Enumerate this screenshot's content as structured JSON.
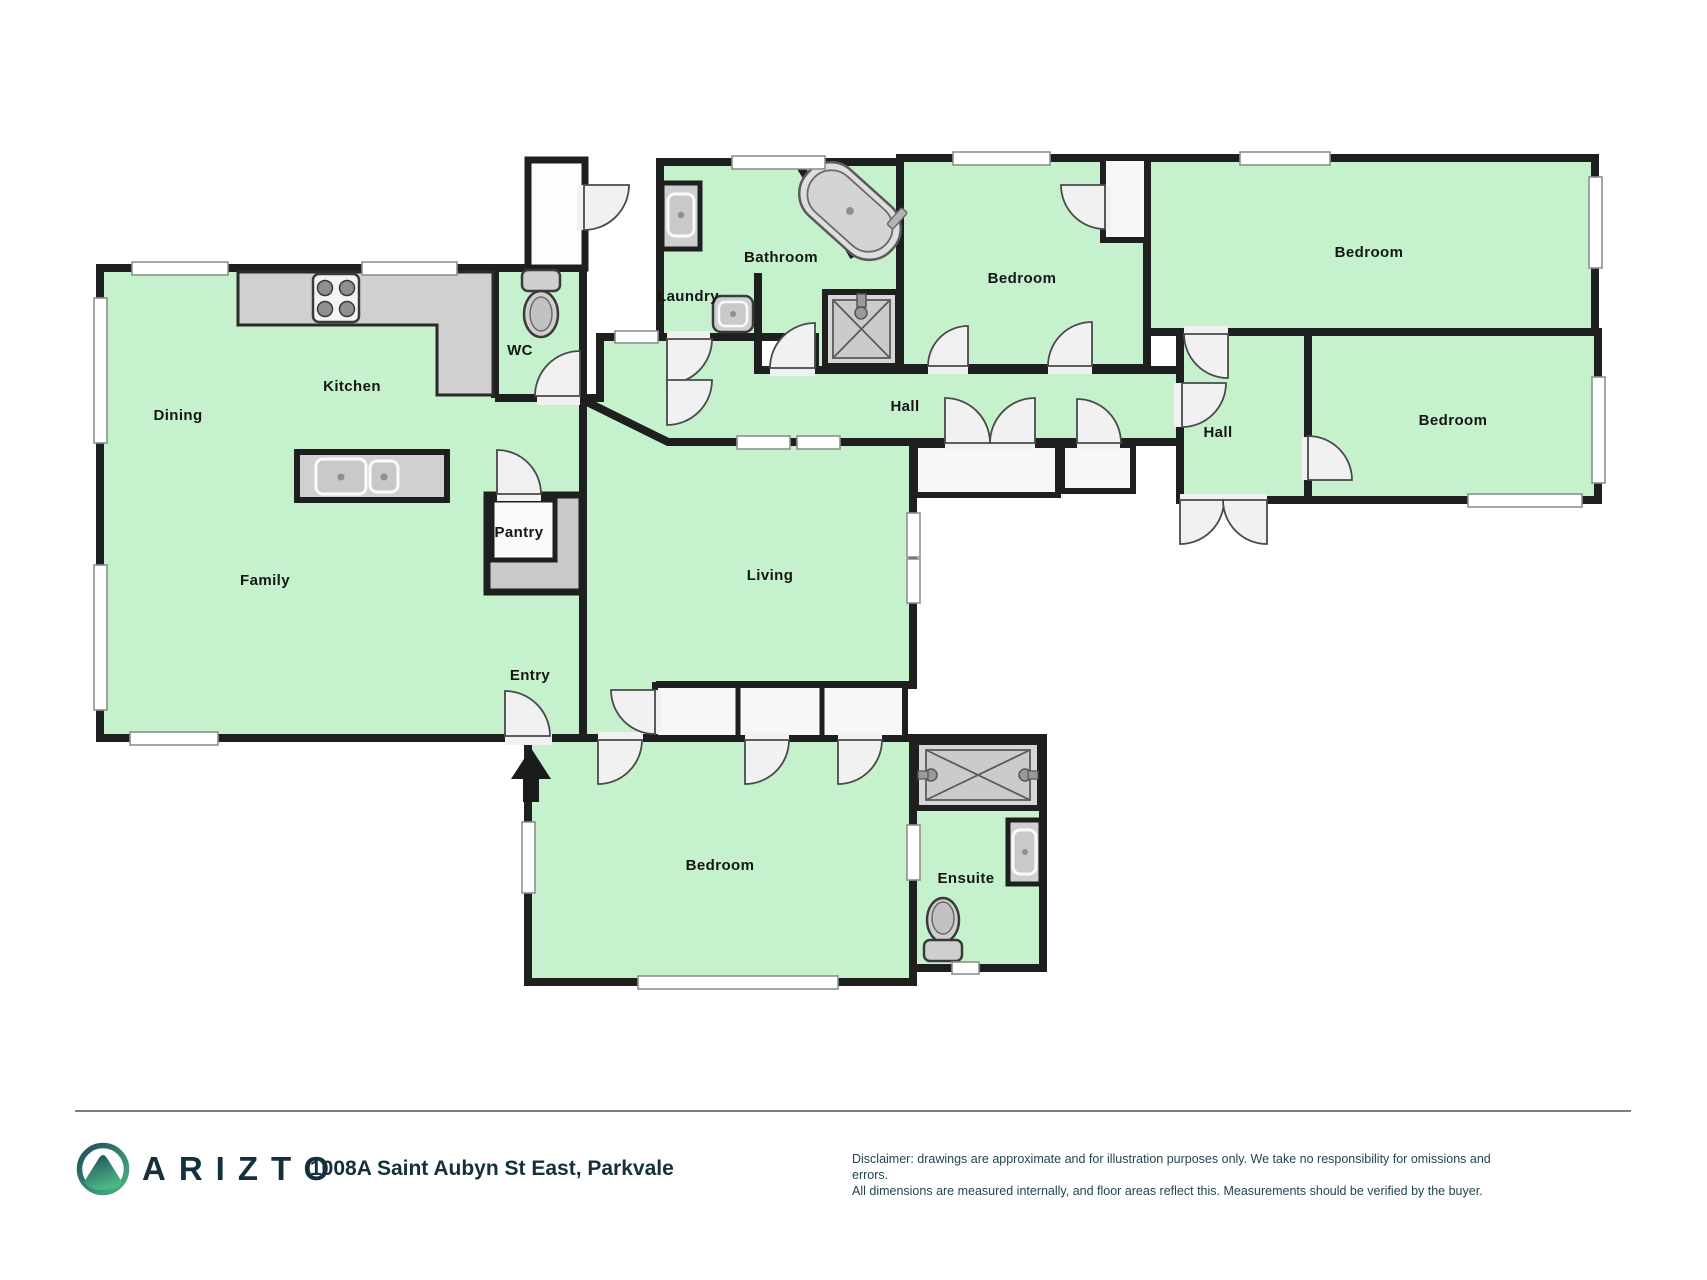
{
  "plan": {
    "rooms": [
      {
        "id": "dining",
        "label": "Dining",
        "x": 178,
        "y": 420
      },
      {
        "id": "kitchen",
        "label": "Kitchen",
        "x": 352,
        "y": 391
      },
      {
        "id": "family",
        "label": "Family",
        "x": 265,
        "y": 585
      },
      {
        "id": "wc",
        "label": "WC",
        "x": 520,
        "y": 355
      },
      {
        "id": "pantry",
        "label": "Pantry",
        "x": 519,
        "y": 537
      },
      {
        "id": "entry",
        "label": "Entry",
        "x": 530,
        "y": 680
      },
      {
        "id": "laundry",
        "label": "Laundry",
        "x": 688,
        "y": 301
      },
      {
        "id": "bathroom",
        "label": "Bathroom",
        "x": 781,
        "y": 262
      },
      {
        "id": "hall-1",
        "label": "Hall",
        "x": 905,
        "y": 411
      },
      {
        "id": "hall-2",
        "label": "Hall",
        "x": 1218,
        "y": 437
      },
      {
        "id": "bedroom-1",
        "label": "Bedroom",
        "x": 1022,
        "y": 283
      },
      {
        "id": "bedroom-2",
        "label": "Bedroom",
        "x": 1369,
        "y": 257
      },
      {
        "id": "bedroom-3",
        "label": "Bedroom",
        "x": 1453,
        "y": 425
      },
      {
        "id": "bedroom-4",
        "label": "Bedroom",
        "x": 720,
        "y": 870
      },
      {
        "id": "living",
        "label": "Living",
        "x": 770,
        "y": 580
      },
      {
        "id": "ensuite",
        "label": "Ensuite",
        "x": 966,
        "y": 883
      }
    ]
  },
  "colors": {
    "floor_green": "#c5f2cc",
    "wall": "#1f1f1f",
    "brand_dark": "#14303d",
    "logo_teal": "#1d4b5b",
    "logo_green": "#4cb782"
  },
  "footer": {
    "brand": "ARIZTO",
    "address": "1008A Saint Aubyn St East, Parkvale",
    "disclaimer_line1": "Disclaimer: drawings are approximate and for illustration purposes only. We take no responsibility for omissions and errors.",
    "disclaimer_line2": "All dimensions are measured internally, and floor areas reflect this. Measurements should be verified by the buyer."
  }
}
